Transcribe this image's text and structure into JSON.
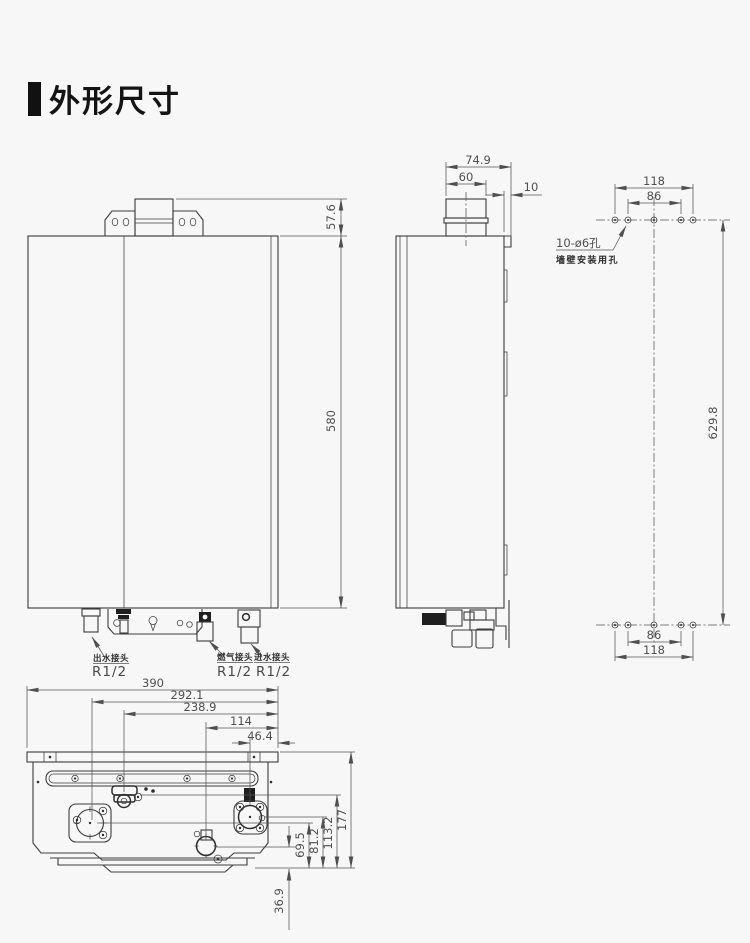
{
  "page": {
    "bg": "#f7f7f7",
    "line_ink": "#3d3d3d",
    "dim_ink": "#4f4f4f",
    "title_color": "#141414"
  },
  "header": {
    "title": "外形尺寸"
  },
  "front_view": {
    "dim_bracket_height": "57.6",
    "dim_body_height": "580",
    "connections": [
      {
        "label": "出水接头",
        "thread": "R1/2"
      },
      {
        "label": "燃气接头",
        "thread": "R1/2"
      },
      {
        "label": "进水接头",
        "thread": "R1/2"
      }
    ]
  },
  "side_view": {
    "dim_flue_span": "74.9",
    "dim_flue_width": "60",
    "dim_wall_gap": "10"
  },
  "mount_pattern": {
    "dim_outer_width_top": "118",
    "dim_inner_width_top": "86",
    "dim_height": "629.8",
    "dim_inner_width_bottom": "86",
    "dim_outer_width_bottom": "118",
    "note_holes": "10-ø6孔",
    "note_purpose": "墙壁安装用孔"
  },
  "bottom_view": {
    "dim_total_width": "390",
    "dim_outlet_x": "292.1",
    "dim_clip_x": "238.9",
    "dim_inlet_x": "114",
    "dim_gas_x": "46.4",
    "dim_total_depth": "177",
    "dim_clip_y": "113.2",
    "dim_gas_y": "81.2",
    "dim_outlet_y": "69.5",
    "dim_inlet_y": "36.9"
  }
}
